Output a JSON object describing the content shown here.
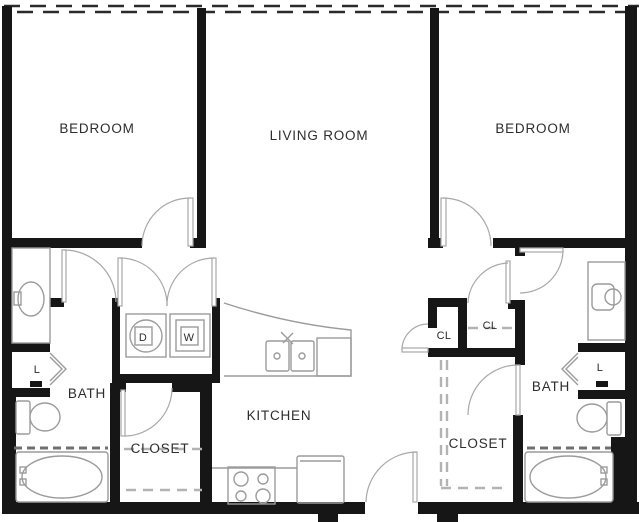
{
  "labels": {
    "bedroom_left": "BEDROOM",
    "living_room": "LIVING ROOM",
    "bedroom_right": "BEDROOM",
    "bath_left": "BATH",
    "bath_right": "BATH",
    "kitchen": "KITCHEN",
    "closet_left": "CLOSET",
    "closet_right": "CLOSET",
    "cl_hall": "CL",
    "cl_pantry": "CL",
    "linen_left": "L",
    "linen_right": "L",
    "dryer": "D",
    "washer": "W"
  },
  "colors": {
    "wall": "#161616",
    "fixture_line": "#9b9b9b",
    "door_arc": "#a8a8a8",
    "rod_dark": "#6f6f6f",
    "rod_light": "#b3b3b3",
    "label": "#2d2d2d",
    "window_dash": "#2b2b2b",
    "background": "#ffffff"
  }
}
